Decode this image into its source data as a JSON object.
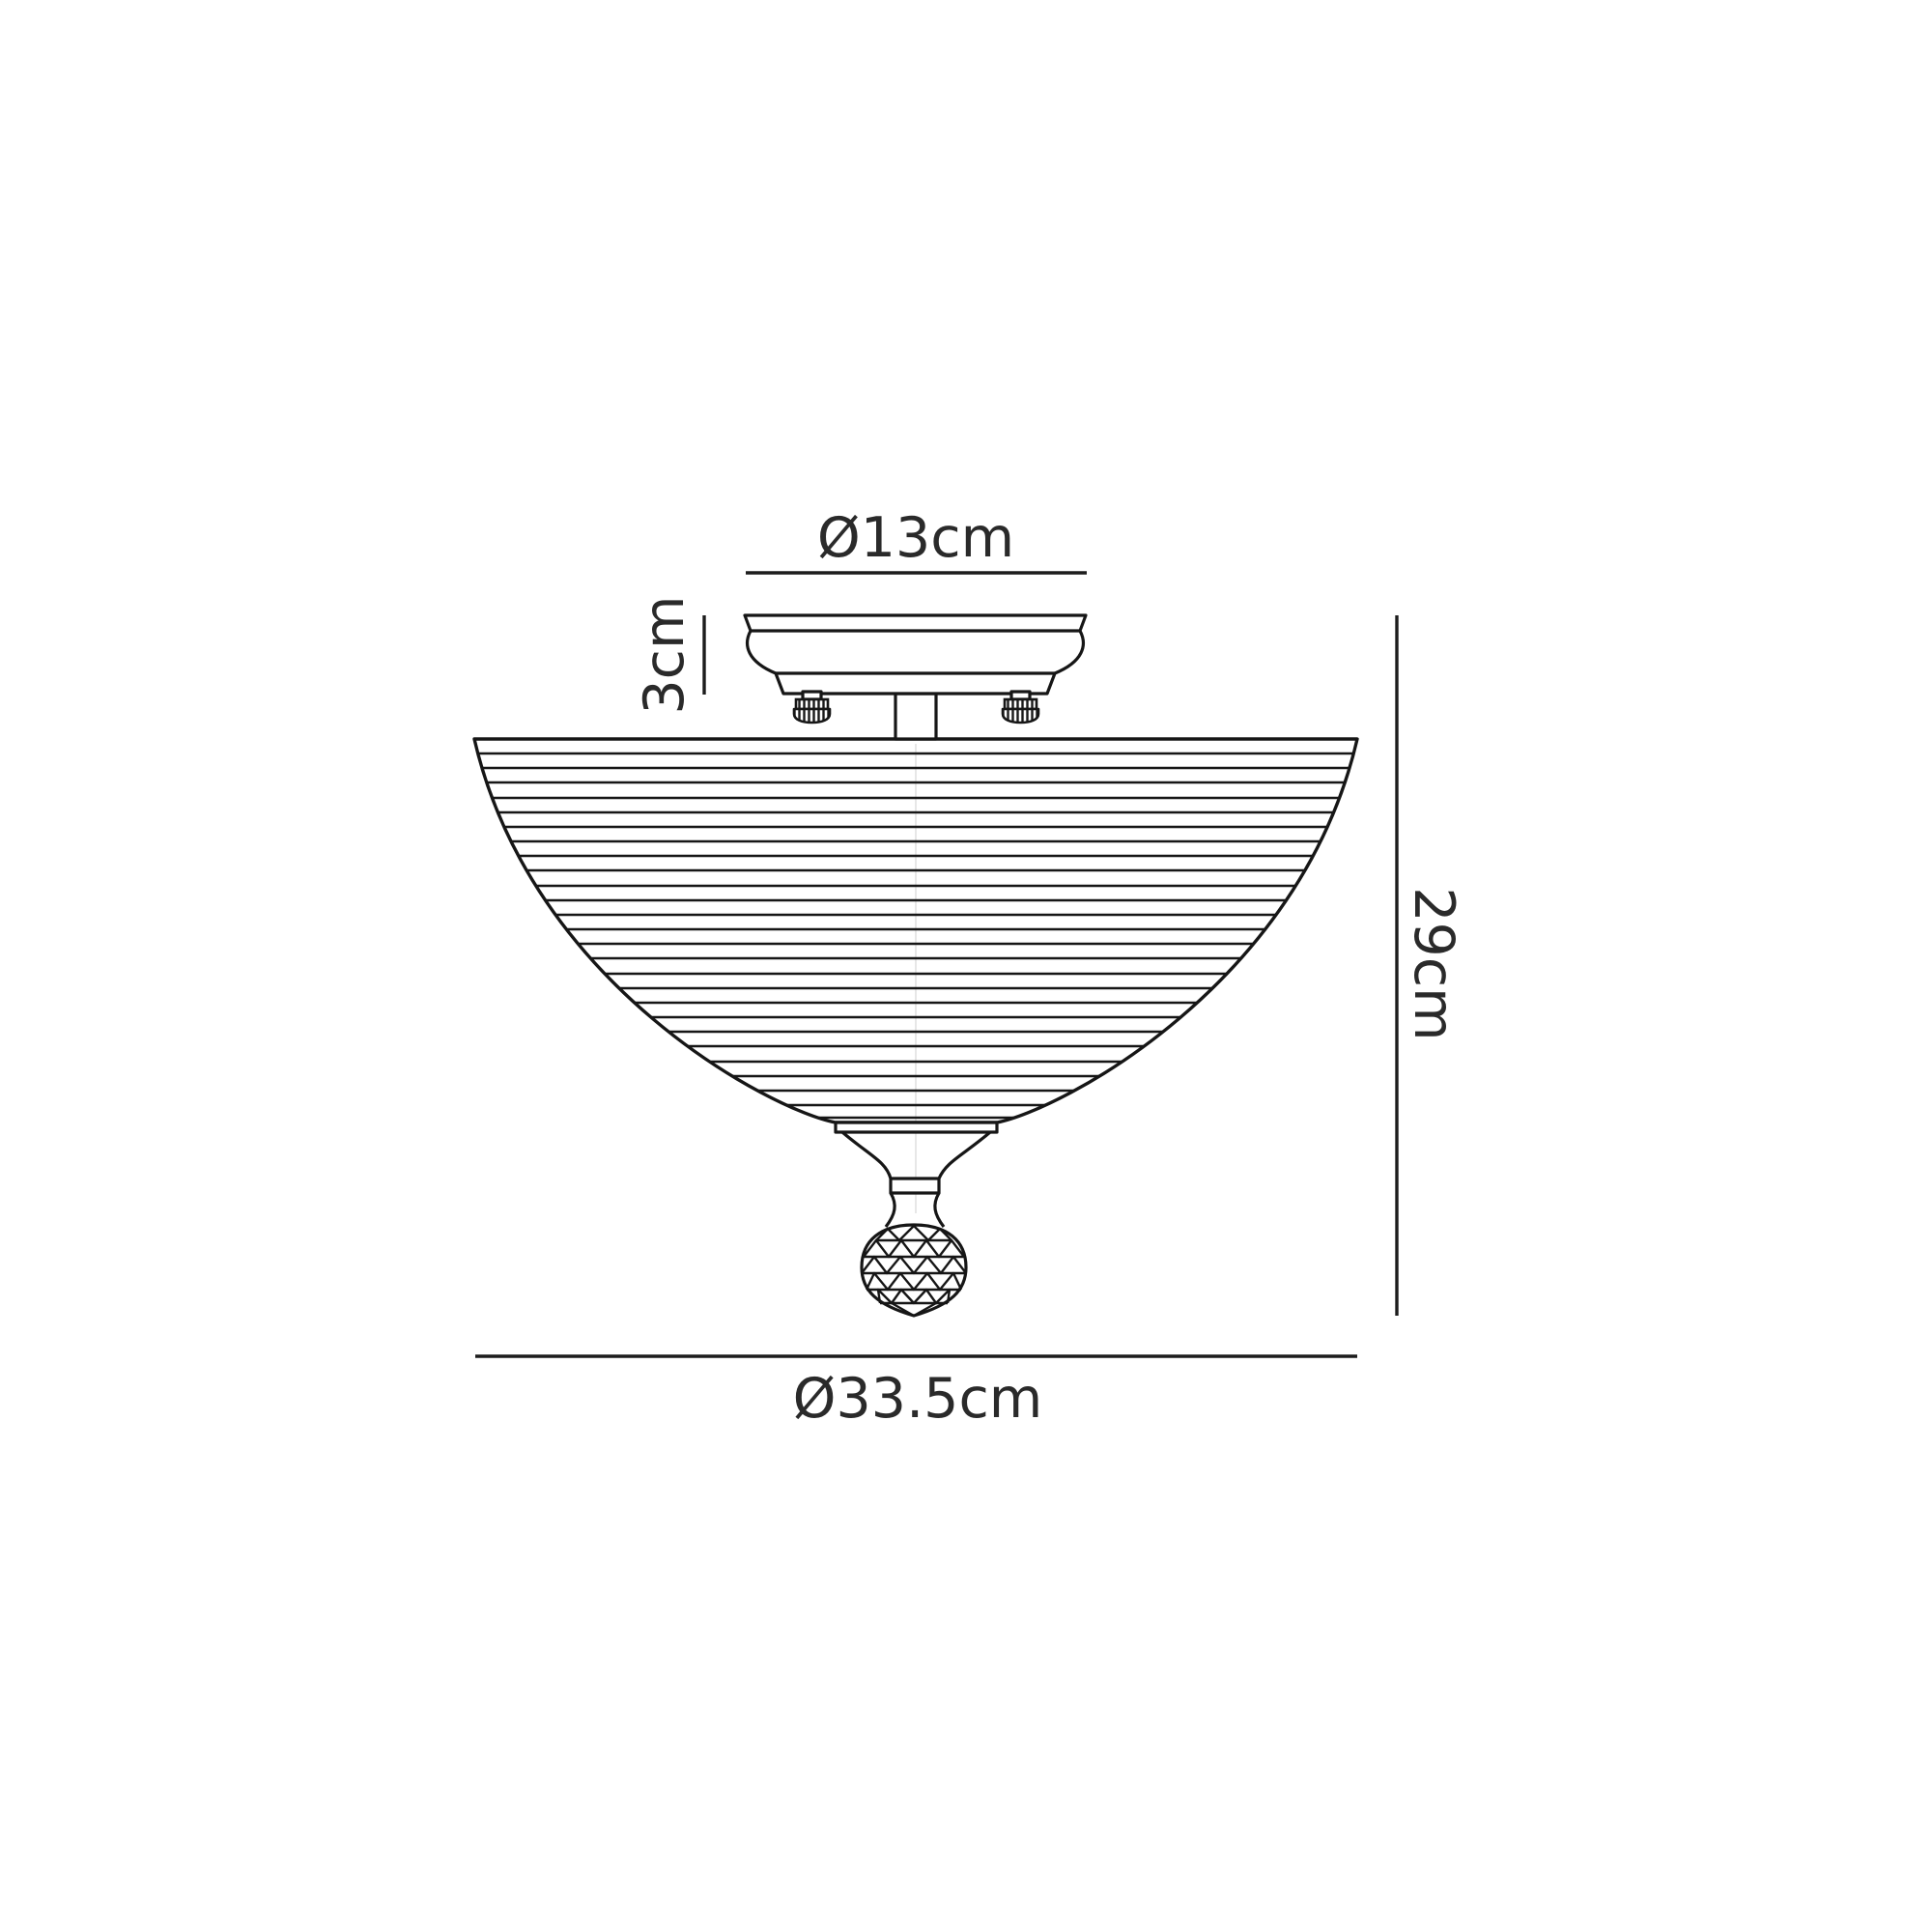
{
  "diagram": {
    "background": "#ffffff",
    "line_color": "#161616",
    "text_color": "#2a2a2a",
    "labels": {
      "canopy_diameter": "Ø13cm",
      "canopy_height": "3cm",
      "overall_height": "29cm",
      "shade_diameter": "Ø33.5cm"
    }
  }
}
